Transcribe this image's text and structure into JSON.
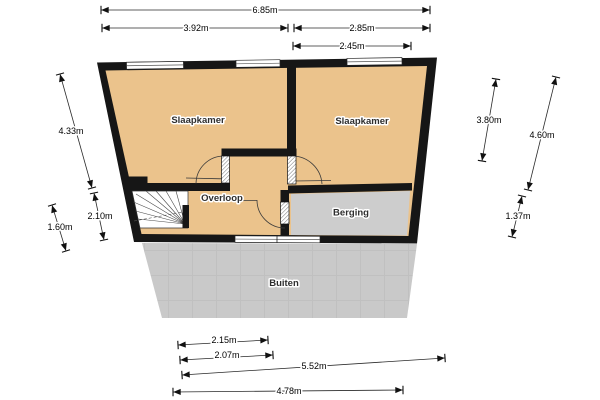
{
  "palette": {
    "floor_fill": "#EBC38C",
    "storage_fill": "#CDCDCD",
    "outside_fill": "#C9C9C9",
    "wall_color": "#161616",
    "background": "#FFFFFF"
  },
  "rooms": {
    "bedroom_left": "Slaapkamer",
    "bedroom_right": "Slaapkamer",
    "landing": "Overloop",
    "storage": "Berging",
    "outside": "Buiten"
  },
  "dimensions": {
    "top_total": "6.85m",
    "top_left_section": "3.92m",
    "top_right_section": "2.85m",
    "top_right_inner": "2.45m",
    "left_upper": "4.33m",
    "left_lower_inner": "2.10m",
    "left_lower_outer": "1.60m",
    "right_inner": "3.80m",
    "right_outer": "4.60m",
    "right_lower": "1.37m",
    "bottom_inner_a": "2.15m",
    "bottom_inner_b": "2.07m",
    "bottom_diagonal": "5.52m",
    "bottom_outer": "4.78m"
  }
}
